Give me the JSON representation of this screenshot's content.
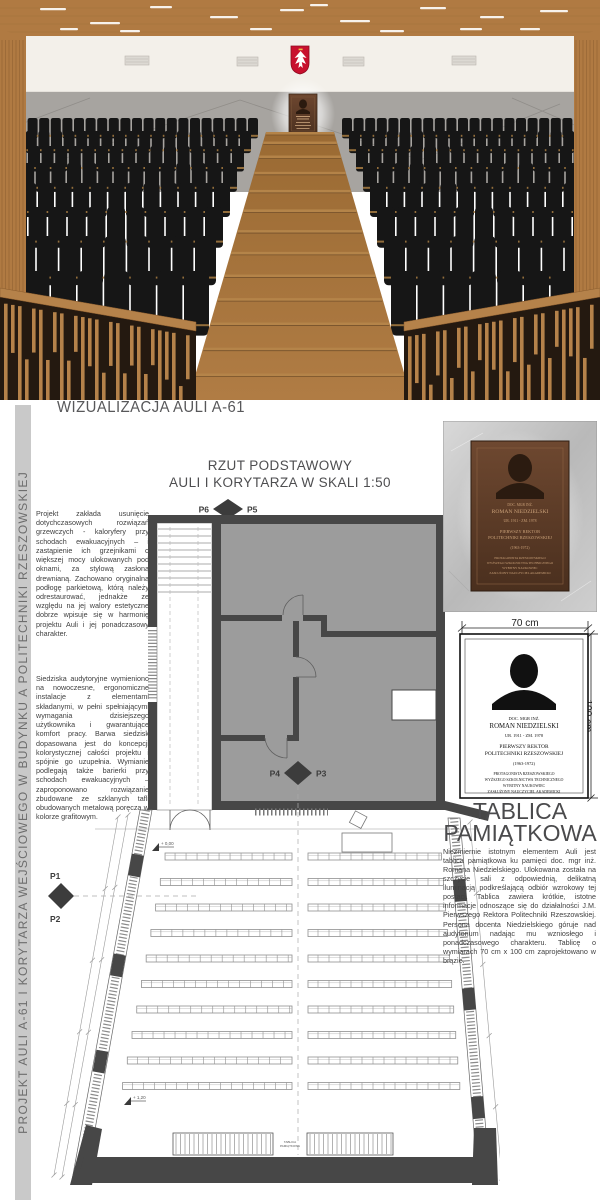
{
  "side_strip": {
    "text": "PROJEKT AULI A-61 I KORYTARZA WEJŚCIOWEGO W BUDYNKU A POLITECHNIKI RZESZOWSKIEJ"
  },
  "sections": {
    "visualization_title": "WIZUALIZACJA AULI A-61",
    "plan_title_line1": "RZUT PODSTAWOWY",
    "plan_title_line2": "AULI I KORYTARZA W SKALI 1:50",
    "memorial_heading_line1": "TABLICA",
    "memorial_heading_line2": "PAMIĄTKOWA"
  },
  "paragraphs": {
    "heating": "Projekt zakłada usunięcie dotychczasowych rozwiązań grzewczych - kaloryfery przy schodach ewakuacyjnych – i zastąpienie ich grzejnikami o większej mocy ulokowanych pod oknami, za stylową zasłoną drewnianą. Zachowano oryginalną podłogę parkietową, którą należy odrestaurować, jednakże ze względu na jej walory estetyczne dobrze wpisuje się w harmonię projektu Auli i jej ponadczasowy charakter.",
    "seating": "Siedziska audytoryjne wymieniono na nowoczesne, ergonomiczne instalacje z elementami składanymi, w pełni spełniającymi wymagania dzisiejszego użytkownika i gwarantujące komfort pracy. Barwa siedzisk dopasowana jest do koncepcji kolorystycznej całości projektu i spójnie go uzupełnia. Wymianie podlegają także barierki przy schodach ewakuacyjnych – zaproponowano rozwiązanie zbudowane ze szklanych tafli obudowanych metalową poręczą w kolorze grafitowym.",
    "memorial": "Niezmiernie istotnym elementem Auli jest tablica pamiątkowa ku pamięci doc. mgr inż. Romana Niedzielskiego. Ulokowana została na szczycie sali z odpowiednią, delikatną iluminacją podkreślającą odbiór wzrokowy tej postaci. Tablica zawiera krótkie, istotne informacje odnoszące się do działalności J.M. Pierwszego Rektora Politechniki Rzeszowskiej. Persona docenta Niedzielskiego góruje nad audytorium nadając mu wzniosłego i ponadczasowego charakteru. Tablicę o wymiarach 70 cm x 100 cm zaprojektowano w brązie."
  },
  "plan": {
    "markers": {
      "p1": "P1",
      "p2": "P2",
      "p3": "P3",
      "p4": "P4",
      "p5": "P5",
      "p6": "P6"
    },
    "elevation_a": "+ 0,00",
    "elevation_b": "+ 1,20",
    "plaque_location_line1": "TABLICA",
    "plaque_location_line2": "PAMIĄTKOWA"
  },
  "plaque": {
    "degree": "DOC. MGR INŻ.",
    "name": "ROMAN NIEDZIELSKI",
    "dates": "UR. 1911 - ZM. 1978",
    "role_line1": "PIERWSZY REKTOR",
    "role_line2": "POLITECHNIKI RZESZOWSKIEJ",
    "tenure": "(1963-1972)",
    "desc_line1": "PROTAGONISTA RZESZOWSKIEGO",
    "desc_line2": "WYŻSZEGO SZKOLNICTWA TECHNICZNEGO",
    "desc_line3": "WYBITNY NAUKOWIEC",
    "desc_line4": "ZASŁUŻONY NAUCZYCIEL AKADEMICKI",
    "width_label": "70 cm",
    "height_label": "100 cm"
  },
  "colors": {
    "wall_dark": "#474747",
    "room_fill": "#9c9c9c",
    "plaque_brown": "#5d3c28",
    "wood": "#b07a42",
    "seat_black": "#161616",
    "eagle_red": "#c8102e"
  }
}
